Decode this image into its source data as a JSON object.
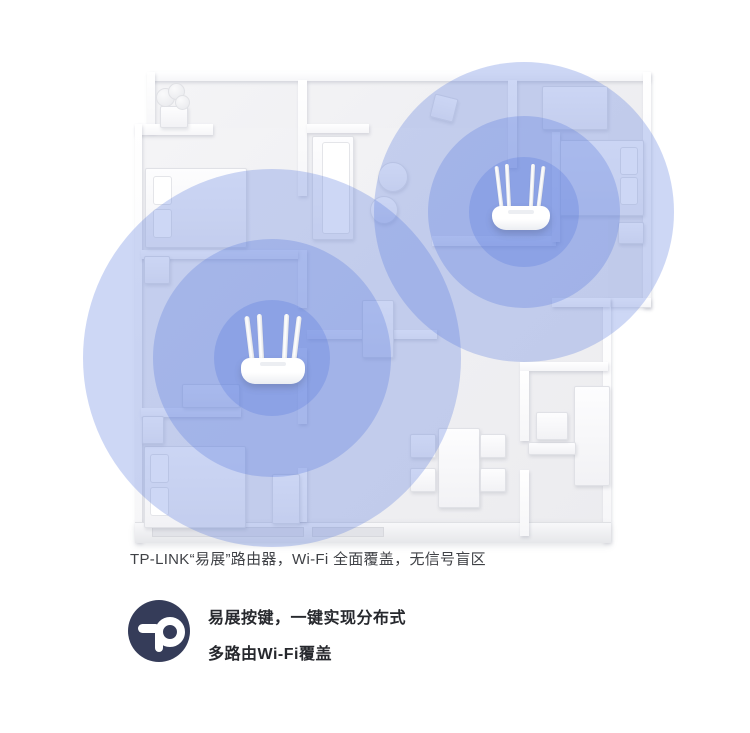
{
  "caption": {
    "text": "TP-LINK“易展”路由器，Wi-Fi 全面覆盖，无信号盲区"
  },
  "features": {
    "line1": "易展按键，一键实现分布式",
    "line2": "多路由Wi-Fi覆盖"
  },
  "logo": {
    "name": "tp-link-logo",
    "background": "#353C59",
    "glyph_color": "#FFFFFF"
  },
  "colors": {
    "coverage_blue": "#5578DD",
    "coverage_opacity": "0.30",
    "floor": "#F1F1F4",
    "wall": "#FFFFFF",
    "caption_text": "#3F4146",
    "feature_text": "#26282D",
    "page_background": "#FFFFFF"
  },
  "devices": [
    {
      "name": "router-1",
      "antennas": 4,
      "coverage_rings": 3
    },
    {
      "name": "router-2",
      "antennas": 4,
      "coverage_rings": 3
    }
  ]
}
